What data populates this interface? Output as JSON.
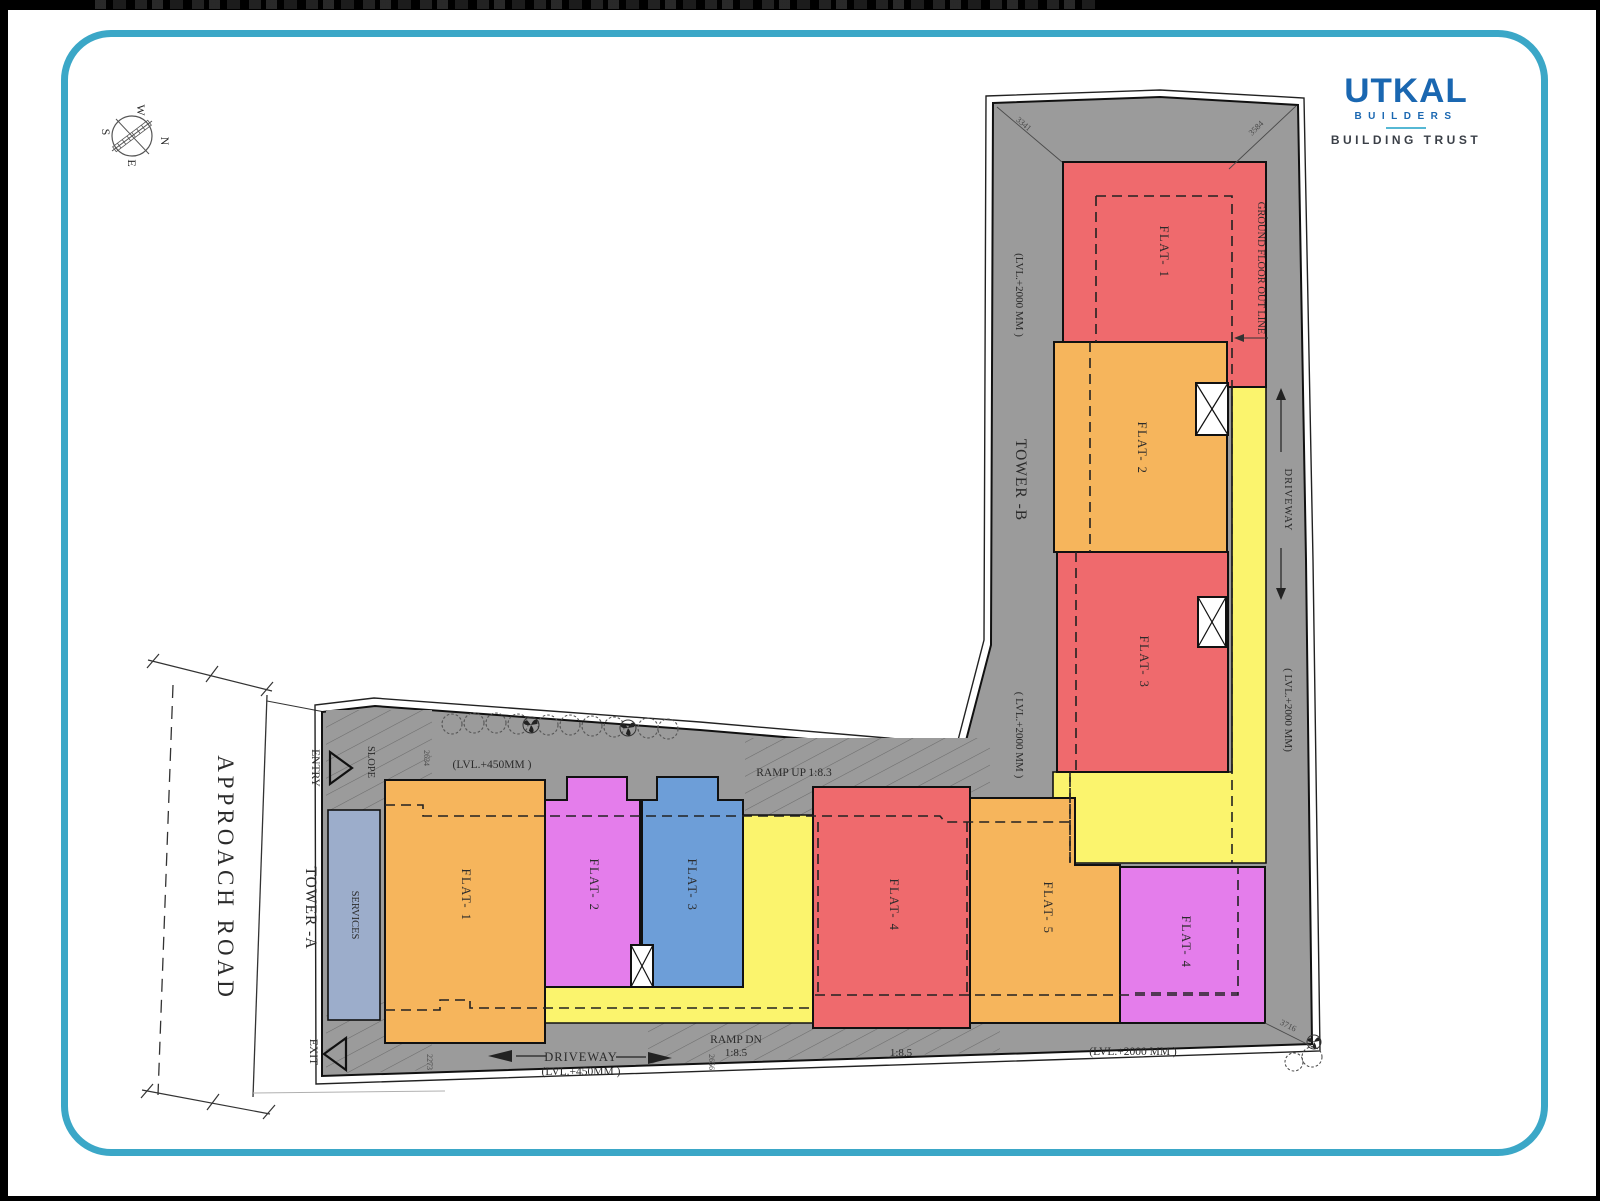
{
  "colors": {
    "gray": "#9b9b9b",
    "red": "#ef6a6d",
    "orange": "#f6b55c",
    "yellow": "#fbf46d",
    "magenta": "#e47deb",
    "blue": "#6d9ed8",
    "services": "#9cadcb",
    "teal": "#3ba7c7",
    "logo_blue": "#1a67b1"
  },
  "logo": {
    "brand": "UTKAL",
    "builders": "BUILDERS",
    "tagline": "BUILDING TRUST"
  },
  "compass": {
    "n": "N",
    "e": "E",
    "s": "S",
    "w": "W"
  },
  "plan": {
    "approach_road": "APPROACH  ROAD",
    "entry": "ENTRY",
    "exit": "EXIT",
    "slope": "SLOPE",
    "services": "SERVICES",
    "tower_a": "TOWER -A",
    "tower_b": "TOWER -B",
    "ground_floor_outline": "GROUND FLOOR  OUT LINE",
    "driveway_vert": "DRIVEWAY",
    "lvl2000_left": "(LVL.+2000 MM )",
    "lvl2000_mid": "( LVL.+2000 MM )",
    "lvl2000_right": "( LVL.+2000 MM)",
    "lvl2000_bottom": "(LVL.+2000 MM )",
    "lvl450_top": "(LVL.+450MM )",
    "lvl450_bottom": "(LVL.+450MM )",
    "ramp_up": "RAMP UP  1:8.3",
    "ramp_dn": "RAMP DN",
    "ramp_dn_ratio": "1:8.5",
    "ratio_85": "1:8.5",
    "driveway_bottom": "DRIVEWAY",
    "flats_b": [
      {
        "label": "FLAT- 1",
        "color": "#ef6a6d"
      },
      {
        "label": "FLAT- 2",
        "color": "#f6b55c"
      },
      {
        "label": "FLAT- 3",
        "color": "#ef6a6d"
      }
    ],
    "flats_a": [
      {
        "label": "FLAT- 1",
        "color": "#f6b55c"
      },
      {
        "label": "FLAT- 2",
        "color": "#e47deb"
      },
      {
        "label": "FLAT- 3",
        "color": "#6d9ed8"
      },
      {
        "label": "FLAT- 4",
        "color": "#ef6a6d"
      },
      {
        "label": "FLAT- 5",
        "color": "#f6b55c"
      },
      {
        "label": "FLAT- 4",
        "color": "#e47deb"
      }
    ],
    "dims": {
      "top_left": "3341",
      "top_right": "3584",
      "left_top": "2634",
      "left_bottom": "2273",
      "bottom_mid": "2656",
      "bottom_right": "3716"
    }
  }
}
